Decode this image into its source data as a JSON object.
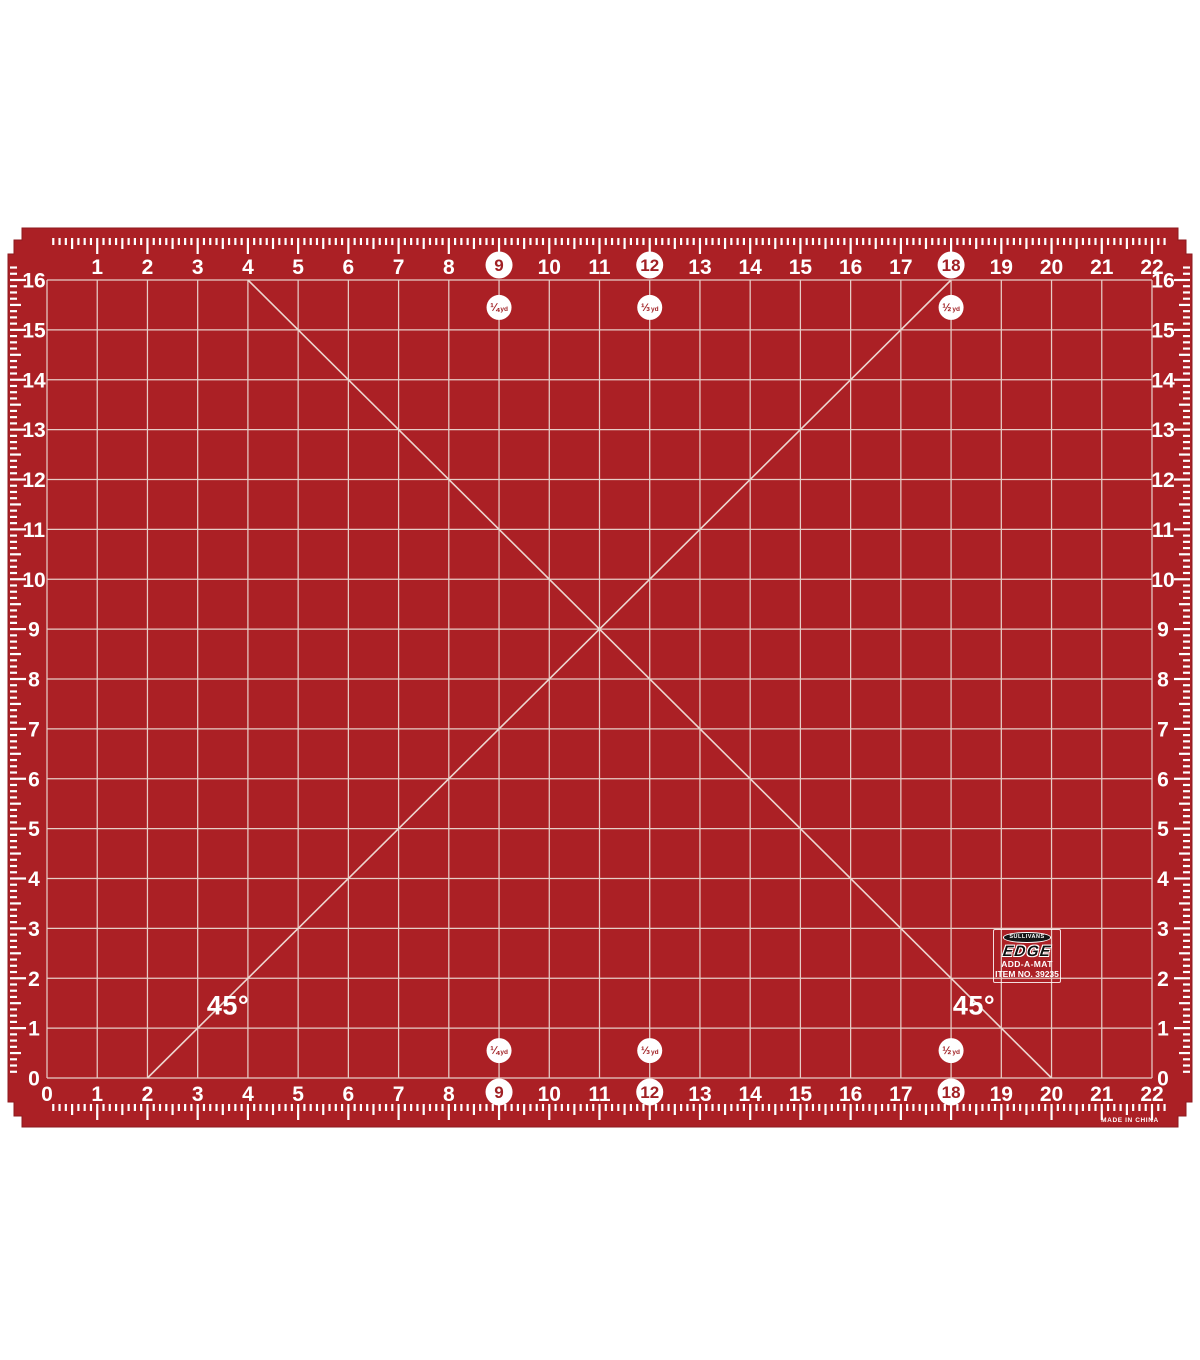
{
  "product": {
    "brand": "SULLIVANS",
    "line": "EDGE",
    "name": "ADD-A-MAT",
    "item": "ITEM NO. 39235",
    "origin": "MADE IN CHINA"
  },
  "mat": {
    "description": "red rotary cutting mat with 1-inch grid, edge rulers and 45-degree bias lines",
    "angle_label": "45°",
    "grid": {
      "columns": 22,
      "rows": 16,
      "unit": "inches"
    },
    "colors": {
      "mat_red": "#AB2025",
      "mat_edge": "#8E1A1E",
      "grid_line": "#E7CDC7",
      "diagonal_line": "#EDD6D0",
      "marking_white": "#FFFFFF",
      "circle_text_red": "#A02024",
      "background": "#FFFFFF"
    },
    "rulers": {
      "top_numbers": [
        1,
        2,
        3,
        4,
        5,
        6,
        7,
        8,
        9,
        10,
        11,
        12,
        13,
        14,
        15,
        16,
        17,
        18,
        19,
        20,
        21,
        22
      ],
      "bottom_numbers": [
        0,
        1,
        2,
        3,
        4,
        5,
        6,
        7,
        8,
        9,
        10,
        11,
        12,
        13,
        14,
        15,
        16,
        17,
        18,
        19,
        20,
        21,
        22
      ],
      "left_numbers": [
        16,
        15,
        14,
        13,
        12,
        11,
        10,
        9,
        8,
        7,
        6,
        5,
        4,
        3,
        2,
        1,
        0
      ],
      "right_numbers": [
        16,
        15,
        14,
        13,
        12,
        11,
        10,
        9,
        8,
        7,
        6,
        5,
        4,
        3,
        2,
        1,
        0
      ],
      "circled_numbers": [
        9,
        12,
        18
      ]
    },
    "yard_markers": [
      {
        "inch": 9,
        "fraction": "¼",
        "unit": "yd"
      },
      {
        "inch": 12,
        "fraction": "⅓",
        "unit": "yd"
      },
      {
        "inch": 18,
        "fraction": "½",
        "unit": "yd"
      }
    ]
  }
}
